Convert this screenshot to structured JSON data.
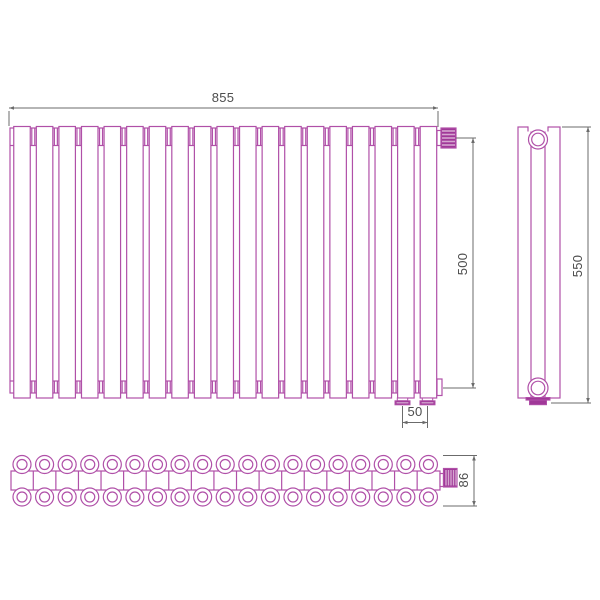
{
  "drawing": {
    "title": "Tubular radiator technical drawing, three orthographic views",
    "views": {
      "front": {
        "name": "front-view",
        "tube_count": 19,
        "back_tube_count": 18,
        "top_valve_position": "top-right",
        "bottom_connection_count": 2
      },
      "side": {
        "name": "side-view",
        "tube_rows": 2,
        "top_plug": "round",
        "bottom_plug": "round-with-base"
      },
      "bottom": {
        "name": "bottom-view",
        "section_count": 19,
        "circle_rows": 2,
        "valve_position": "right-end"
      }
    },
    "dimensions": {
      "width": {
        "value": "855",
        "orientation": "horizontal",
        "applies_to": "front-view overall width"
      },
      "front_height": {
        "value": "500",
        "orientation": "vertical",
        "applies_to": "front-view connection axis height"
      },
      "side_height": {
        "value": "550",
        "orientation": "vertical",
        "applies_to": "side-view overall height"
      },
      "connection_spacing": {
        "value": "50",
        "orientation": "horizontal",
        "applies_to": "bottom connection spacing"
      },
      "depth": {
        "value": "86",
        "orientation": "vertical",
        "applies_to": "bottom-view depth"
      }
    },
    "colors": {
      "line": "#b050a8",
      "fill": "#a03898",
      "stripe": "#d5a6d0",
      "dimension_line": "#6b6b6b",
      "dimension_text": "#4d4d4d",
      "background": "#ffffff"
    }
  }
}
